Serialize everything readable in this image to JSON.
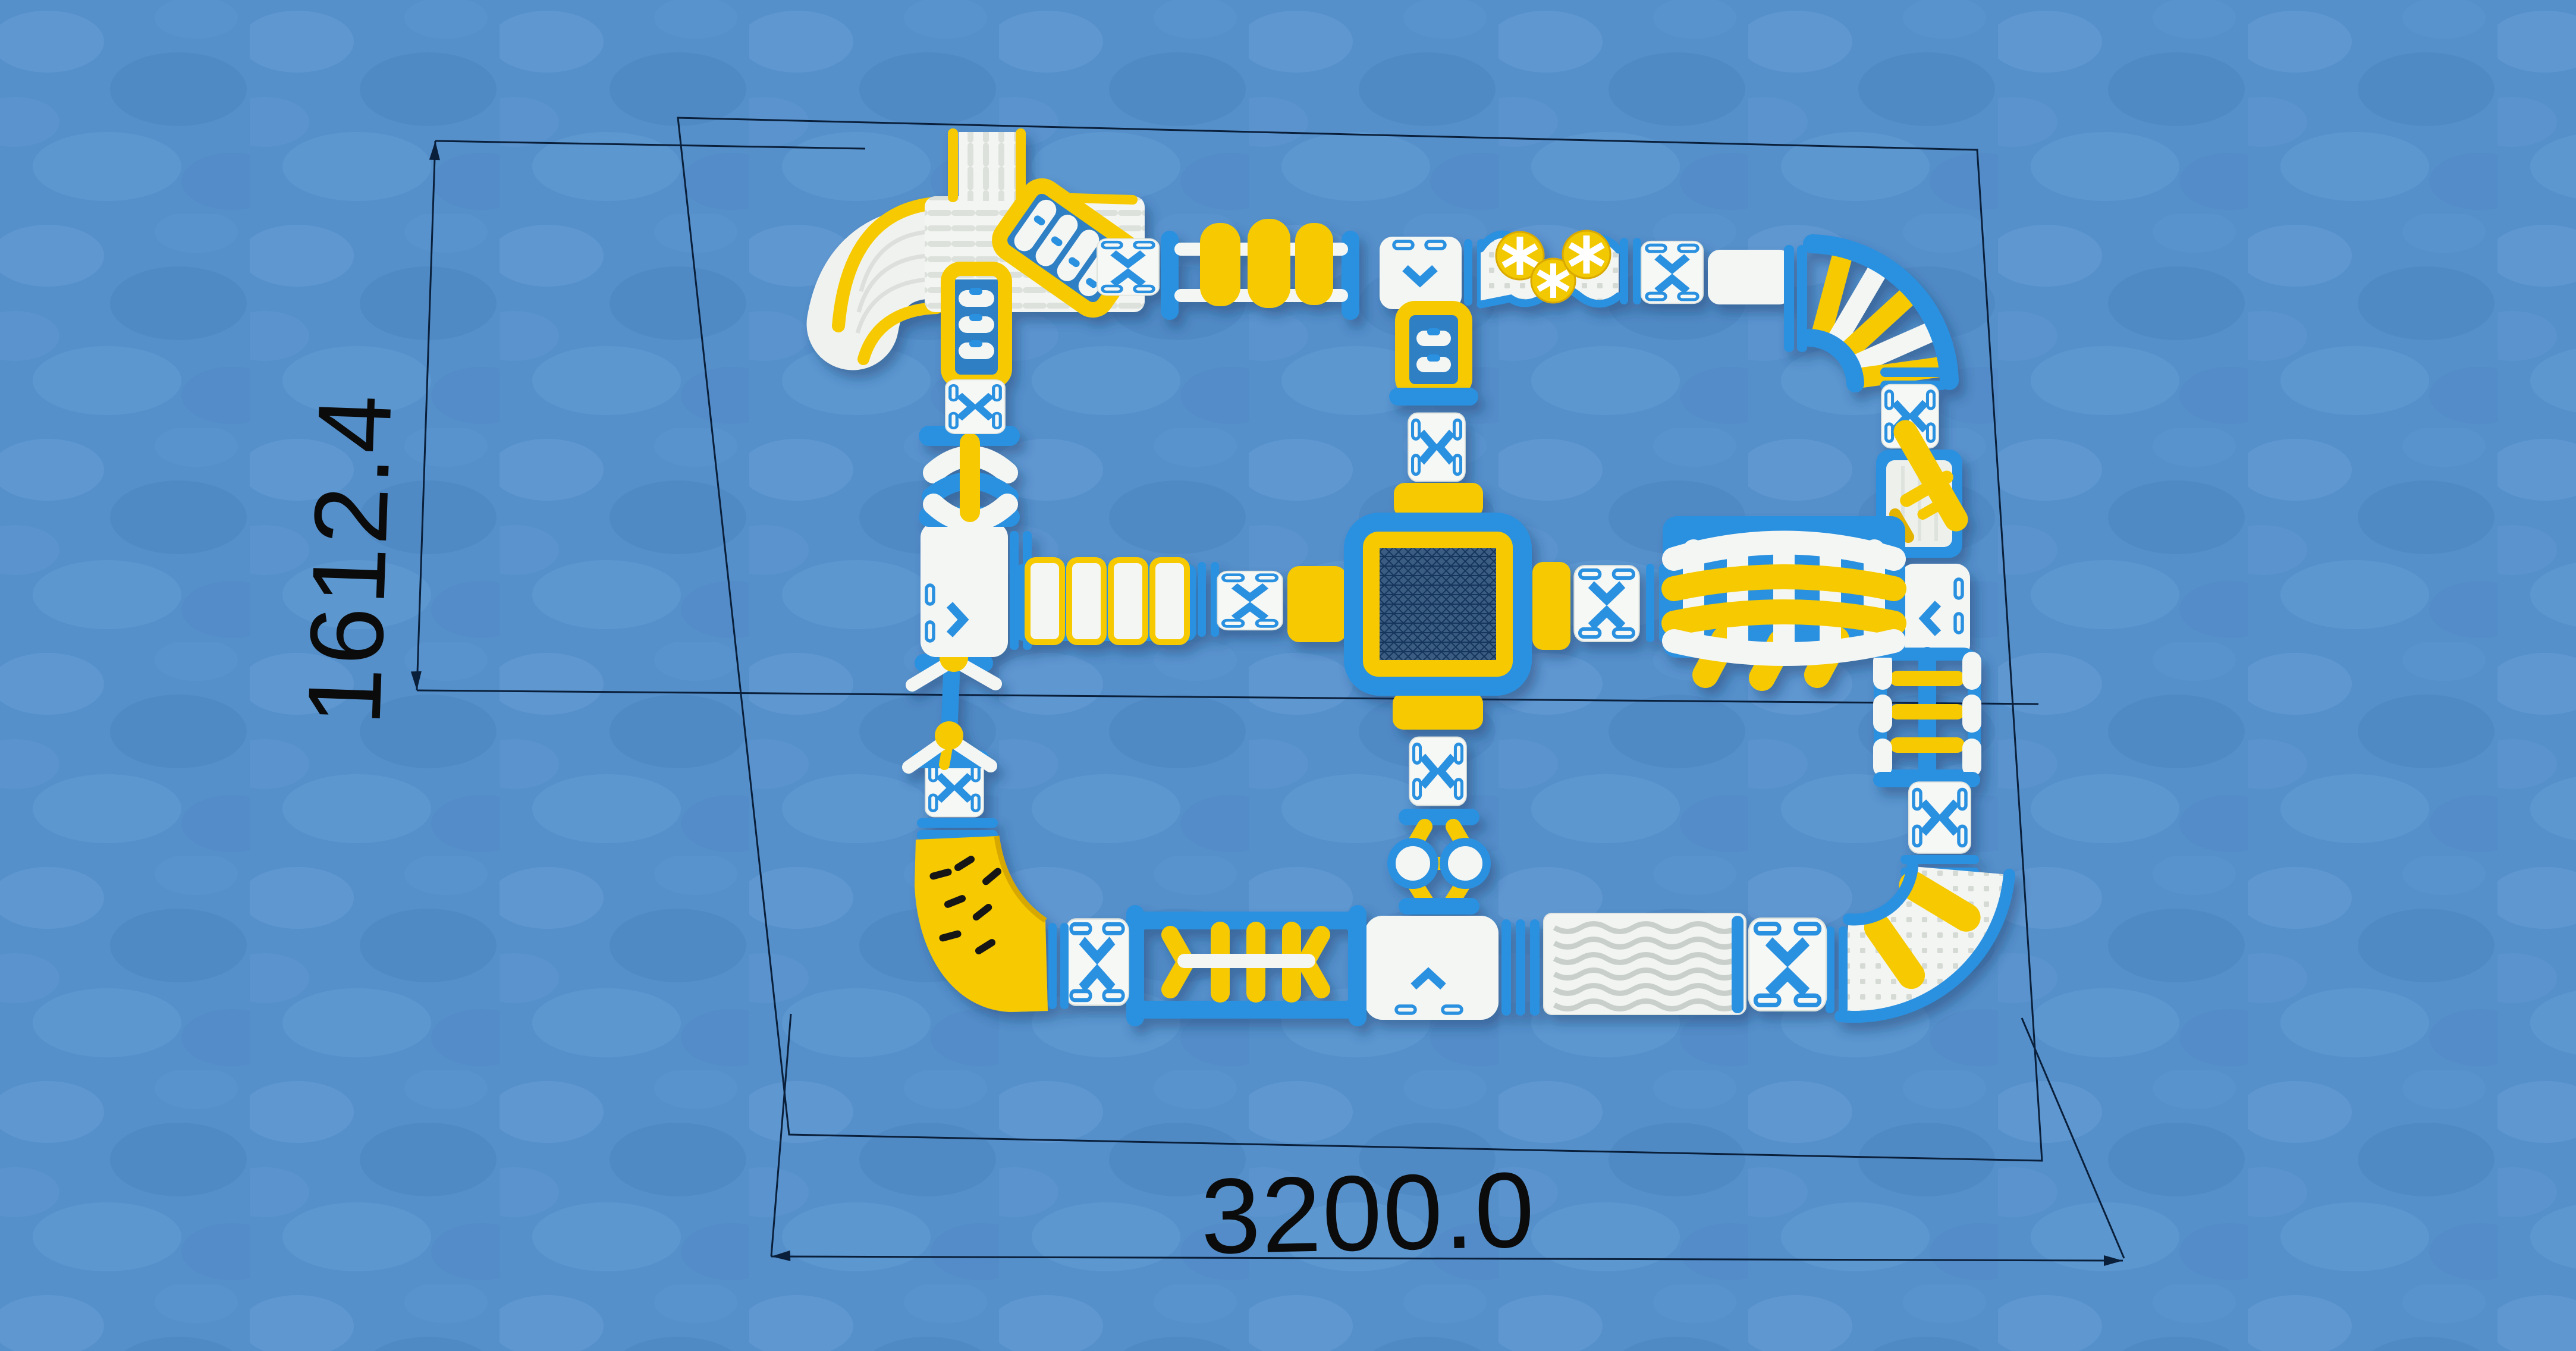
{
  "title": "Inflatable floating water park — top view layout render",
  "dimensions": {
    "height_label": "1612.4",
    "width_label": "3200.0"
  },
  "colors": {
    "water": "#5590cb",
    "tube_blue": "#2b90e0",
    "accent_yellow": "#f6c900",
    "float_white": "#f4f6f3",
    "mesh_navy": "#3a5d82",
    "drawing_line": "#0a1f3a"
  },
  "modules": {
    "slide_complex": "Slide tower with curved slide and climbing ramps",
    "yellow_cylinder_bridge": "Triple roller cylinder bridge",
    "north_platform": "North junction platform with rope ladder",
    "ball_walkway": "Wave walkway with spinner balls",
    "corner_ladder_turn": "Quarter-turn rung ladder corner",
    "balance_beam": "Diagonal balance beam platform",
    "east_platform": "East junction platform",
    "monkey_bar_frame": "Monkey-bar climb frame",
    "corner_walkway_turn": "Quarter-turn padded corner with rollers",
    "ripple_mat": "Ripple mat walkway",
    "south_platform": "South junction platform",
    "arch_hurdle_run": "Hurdle run with arched gates",
    "corner_slide_wedge": "Yellow quarter-turn climbing wedge",
    "swing_chain": "Double swing balance chain",
    "west_platform": "West junction platform",
    "stepping_pads": "Stepping pad bridge",
    "trampoline": "Central jumping trampoline",
    "climbing_wall": "Arched climbing wall",
    "saddle_balls": "Twin ball saddle crossing",
    "hurdle_arches": "Over-under arch hurdles",
    "chevron_pad": "Directional floating pad"
  }
}
